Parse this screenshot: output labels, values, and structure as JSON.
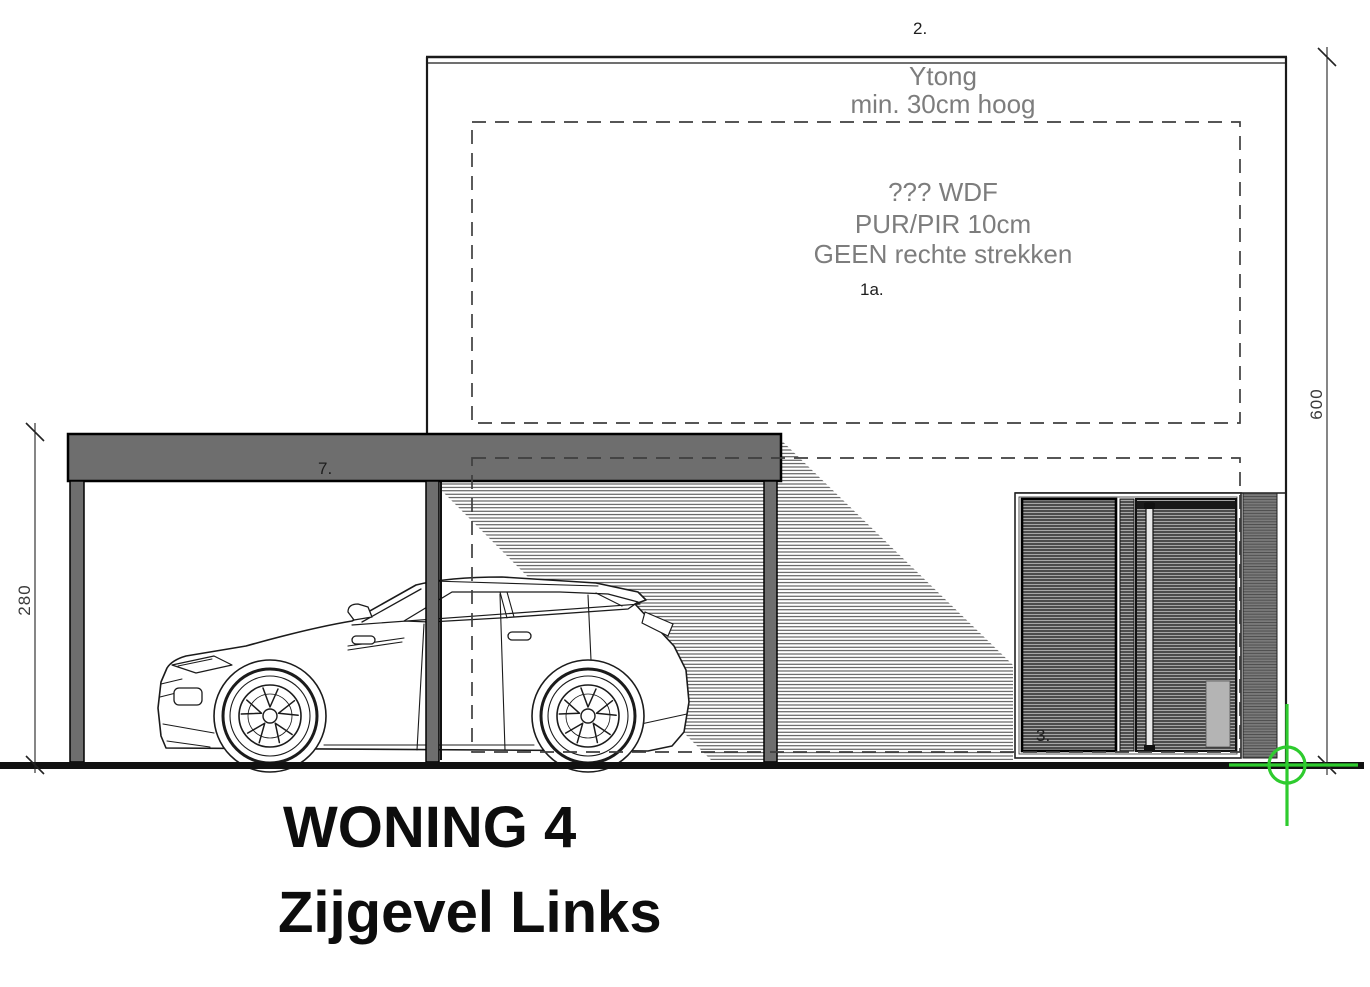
{
  "document": {
    "title_line1": "WONING 4",
    "title_line2": "Zijgevel Links"
  },
  "notes": {
    "wall_note_line1": "Ytong",
    "wall_note_line2": "min. 30cm hoog",
    "insulation_note_line1": "??? WDF",
    "insulation_note_line2": "PUR/PIR 10cm",
    "insulation_note_line3": "GEEN rechte strekken"
  },
  "labels": {
    "roof_edge": "2.",
    "insulation_zone": "1a.",
    "carport_roof": "7.",
    "window": "3."
  },
  "dimensions": {
    "facade_height": "600",
    "carport_height": "280"
  },
  "colors": {
    "marker_green": "#2ecb2e",
    "note_gray": "#7d7d7d",
    "structure_gray": "#6e6e6e"
  }
}
